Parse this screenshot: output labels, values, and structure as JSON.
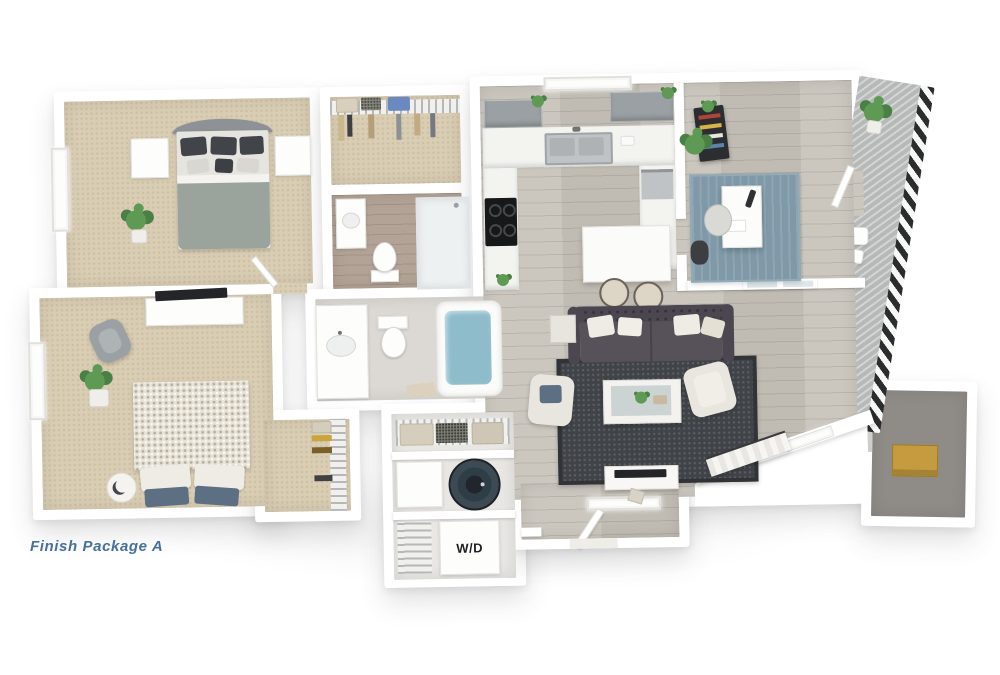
{
  "caption": {
    "text": "Finish Package A"
  },
  "labels": {
    "washer_dryer": "W/D"
  },
  "palette": {
    "wall": "#ffffff",
    "carpet": "#d9cdb4",
    "carpetDot": "#ccbfa3",
    "wood": "#cbc7bf",
    "woodLine": "#c0bcb3",
    "bathWood": "#b3a396",
    "tile": "#dcd9d4",
    "rugBlue": "#7f99a8",
    "rugDark": "#404347",
    "sofa": "#4c4650",
    "sofaSeat": "#575159",
    "pillowLight": "#efece5",
    "pillowBlue": "#5d7083",
    "water": "#8fbccb",
    "plant": "#5f9a55",
    "plantDark": "#4a8045",
    "railing": "#2b2c2e",
    "deck": "#b6b9b7",
    "cabinet": "#9aa0a3",
    "counter": "#f3f3f0",
    "steel": "#bfc3c5",
    "applianceDark": "#17181a",
    "boxYellow": "#c49b3e",
    "captionBlue": "#46719a",
    "blanketKnit": "#e8e3d8",
    "headboard": "#8e9296",
    "blanketGray": "#9ba39d",
    "chairGray": "#9aa0a4",
    "cream": "#e9e6df",
    "tvDark": "#232528",
    "closetFloor": "#8f8c88"
  },
  "scene": {
    "type": "3d-rendered-floor-plan",
    "rooms": [
      {
        "name": "bedroom-1",
        "floor": "tan carpet",
        "furniture": [
          "bed with gray upholstered headboard and dark pillows",
          "two white nightstands",
          "potted plant",
          "window"
        ]
      },
      {
        "name": "walk-in-closet",
        "floor": "tan carpet",
        "furniture": [
          "wire shelving",
          "hanging clothes",
          "storage baskets",
          "blue bin"
        ]
      },
      {
        "name": "bathroom-1",
        "floor": "wood-look",
        "furniture": [
          "walk-in shower",
          "toilet",
          "vanity with sink"
        ]
      },
      {
        "name": "bathroom-2",
        "floor": "light tile",
        "furniture": [
          "vanity with sink",
          "toilet",
          "bathtub with water",
          "bath mat"
        ]
      },
      {
        "name": "kitchen",
        "floor": "gray wood-look",
        "furniture": [
          "U-shaped white counter",
          "double stainless sink under window",
          "gray upper cabinets",
          "black cooktop",
          "stainless dishwasher",
          "small plants"
        ]
      },
      {
        "name": "dining-area",
        "floor": "gray wood-look",
        "furniture": [
          "white dining table",
          "two round upholstered stools"
        ]
      },
      {
        "name": "office-den",
        "floor": "gray wood-look",
        "furniture": [
          "blue area rug",
          "white desk with lamp",
          "desk chair",
          "dark bookshelf with books and plant",
          "dark side chair",
          "french door",
          "balcony door",
          "potted plant"
        ]
      },
      {
        "name": "living-room",
        "floor": "gray wood-look",
        "furniture": [
          "dark tufted sofa with accent pillows",
          "dark patterned rug",
          "coffee table with glass top and plant",
          "two cream armchairs",
          "side table",
          "white TV console with TV",
          "angled entry bench",
          "windows"
        ]
      },
      {
        "name": "bedroom-2",
        "floor": "tan carpet",
        "furniture": [
          "bed with textured knit blanket and blue pillows",
          "white dresser with TV",
          "gray accent chair",
          "potted plant in white planter",
          "crescent side table",
          "window"
        ]
      },
      {
        "name": "closet-2",
        "floor": "tan carpet",
        "furniture": [
          "wire shelving",
          "hanging clothes"
        ]
      },
      {
        "name": "laundry-storage",
        "floor": "light",
        "furniture": [
          "wire shelf with baskets",
          "white storage cube",
          "round water-heater drum",
          "stacked washer-dryer labeled W/D",
          "wire shelving"
        ]
      },
      {
        "name": "entry",
        "floor": "gray wood-look",
        "furniture": [
          "open entry door",
          "angled wall with window",
          "entry closet with yellow storage box"
        ]
      },
      {
        "name": "balcony",
        "floor": "gray decking",
        "furniture": [
          "black metal railing",
          "potted plants",
          "bistro seat and table"
        ]
      }
    ]
  }
}
